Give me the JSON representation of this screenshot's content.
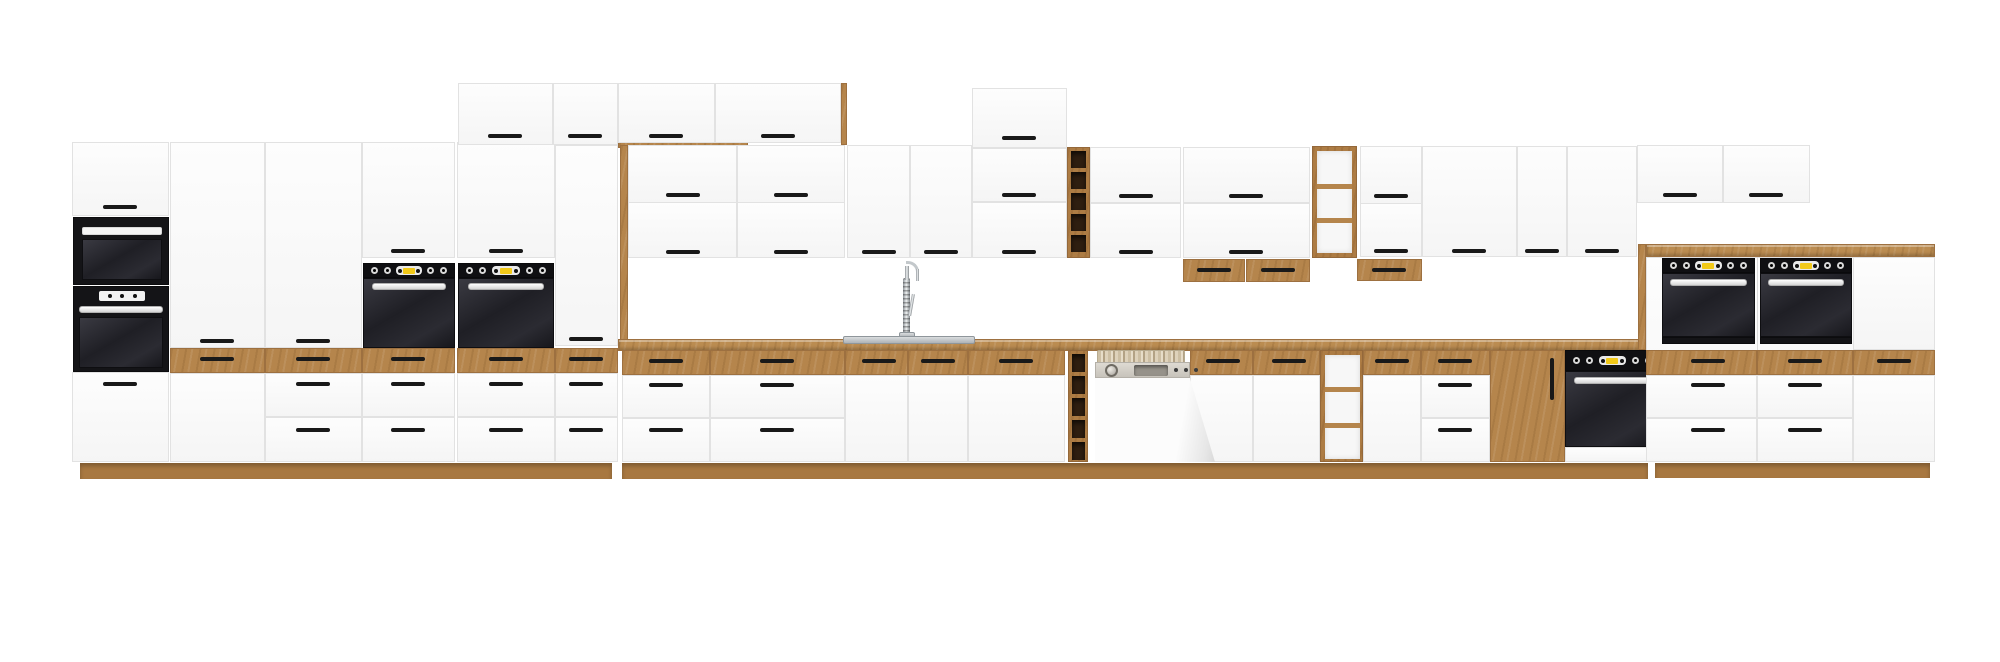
{
  "scene": {
    "description": "Product render of a long modular kitchen cabinet run on a white background: matte white fronts with oak wood accents (countertop, plinth, top drawer fronts, open shelves and wine racks), black bar handles, a tall column with built-in microwave and oven, four black built-in base/column ovens plus two ovens in tall towers on the right, a semi-integrated dishwasher with its door ajar, and a sink with a tall chrome spring faucet.",
    "width_px": 2000,
    "height_px": 662
  },
  "palette": {
    "background": "#ffffff",
    "cabinet_white": "#f9f9f9",
    "cabinet_border": "#e2e2e2",
    "wood": "#b5854c",
    "wood_dark": "#9d7040",
    "plinth_wood": "#a87841",
    "dark_niche": "#2e1e10",
    "appliance_black": "#141417",
    "oven_glass": "#1c1c21",
    "chrome": "#e8e8e8",
    "accent_yellow": "#f2c918",
    "handle_black": "#191919",
    "dishwasher_grey": "#d3cfc7",
    "steel": "#b9bec1"
  },
  "inventory": {
    "front_finish": "matte white",
    "accent_finish": "oak wood",
    "handle_style": "black horizontal bar handles",
    "appliances": {
      "built_in_ovens": 6,
      "microwaves": 1,
      "dishwashers": 1,
      "sinks": 1,
      "faucets": 1
    },
    "features": [
      "tall appliance columns",
      "stacked top boxes above tall units",
      "wall cabinets with lift-up doors over window gap",
      "open oak wine racks (wall and base)",
      "open oak shelf units (wall and base)",
      "oak top drawer fronts along the base run",
      "oak pantry door",
      "continuous oak countertop and plinth",
      "right-hand double oven tower section with oak top"
    ]
  }
}
